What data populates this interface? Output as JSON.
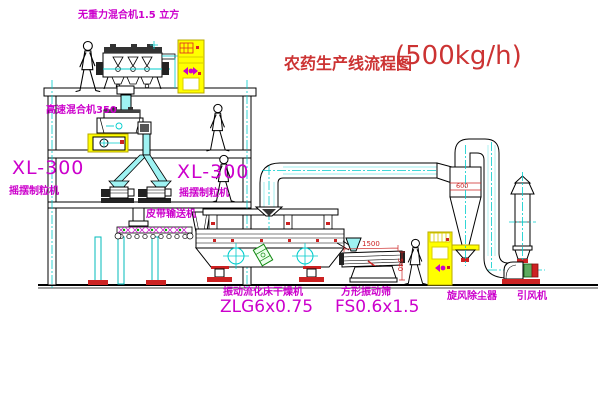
{
  "title": {
    "text": "农药生产线流程图",
    "capacity": "(500kg/h)"
  },
  "equipment_labels": {
    "zero_gravity_mixer": "无重力混合机1.5 立方",
    "high_speed_mixer": "高速混合机350",
    "granulator_left": {
      "model": "XL-300",
      "name": "摇摆制粒机"
    },
    "granulator_right": {
      "model": "XL-300",
      "name": "摇摆制粒机"
    },
    "belt_conveyor": "皮带输送机",
    "fluid_bed_dryer": {
      "name": "振动流化床干燥机",
      "model": "ZLG6x0.75"
    },
    "vibrating_screen": {
      "name": "方形振动筛",
      "model": "FS0.6x1.5"
    },
    "cyclone": "旋风除尘器",
    "induced_draft_fan": "引风机"
  },
  "dimensions": {
    "cyclone_diameter": "600",
    "screen_length": "1500",
    "screen_height": "540"
  },
  "colors": {
    "label_magenta": "#cc00cc",
    "title_red": "#cc3333",
    "centerline_cyan": "#00cccc",
    "cabinet_yellow": "#ffff00",
    "accent_red": "#cc2222",
    "machine_green": "#118811"
  }
}
